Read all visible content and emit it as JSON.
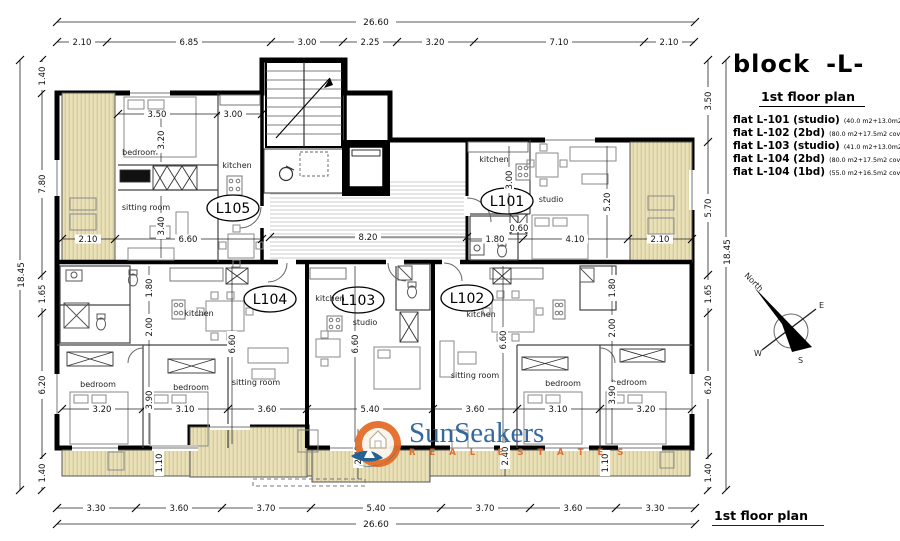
{
  "colors": {
    "wall": "#000000",
    "balcony_fill": "#eae1b9",
    "balcony_hatch": "#cdc291",
    "corridor_hatch": "#c9c9c9",
    "logo_orange": "#e46f2c",
    "logo_blue": "#2b639b",
    "logo_wave_blue": "#1e5d92"
  },
  "title_block": {
    "block_label": "block",
    "block_name": "-L-",
    "plan_title": "1st floor plan",
    "flats": [
      {
        "name": "flat L-101 (studio)",
        "area": "(40.0 m2+13.0m2 cov.ver.)"
      },
      {
        "name": "flat L-102 (2bd)",
        "area": "(80.0 m2+17.5m2 cov.ver.)"
      },
      {
        "name": "flat L-103 (studio)",
        "area": "(41.0 m2+13.0m2 cov.ver.)"
      },
      {
        "name": "flat L-104 (2bd)",
        "area": "(80.0 m2+17.5m2 cov.ver.)"
      },
      {
        "name": "flat L-104 (1bd)",
        "area": "(55.0 m2+16.5m2 cov.ver.)"
      }
    ]
  },
  "footer_title": "1st floor plan",
  "watermark": {
    "brand": "SunSeakers",
    "tagline": "R E A L  E S T A T E S"
  },
  "compass": {
    "north": "North",
    "east": "E",
    "west": "W",
    "south": "S"
  },
  "units": {
    "l101": "L101",
    "l102": "L102",
    "l103": "L103",
    "l104": "L104",
    "l105": "L105"
  },
  "rooms": {
    "bedroom": "bedroom",
    "sitting_room": "sitting room",
    "kitchen": "kitchen",
    "studio": "studio"
  },
  "dims": {
    "top_total": "26.60",
    "top_segments": [
      "2.10",
      "6.85",
      "3.00",
      "2.25",
      "3.20",
      "7.10",
      "2.10"
    ],
    "bottom_total": "26.60",
    "bottom_segments": [
      "3.30",
      "3.60",
      "3.70",
      "5.40",
      "3.70",
      "3.60",
      "3.30"
    ],
    "left_total": "18.45",
    "left_segments": [
      "1.40",
      "7.80",
      "1.65",
      "6.20",
      "1.40"
    ],
    "right_total": "18.45",
    "right_segments": [
      "3.50",
      "5.70",
      "1.65",
      "6.20",
      "1.40"
    ],
    "inner": {
      "l105_bed_w": "3.50",
      "l105_kitchen_w": "3.00",
      "l105_bed_d": "3.20",
      "l105_sitting_d": "3.40",
      "balcony_left_w": "2.10",
      "l105_w": "6.60",
      "corridor_l": "8.20",
      "l101_kitchen_d": "3.00",
      "l101_studio_d": "5.20",
      "l101_hall_w": "0.60",
      "l101_bath_w": "1.80",
      "l101_studio_w": "4.10",
      "balcony_right_w": "2.10",
      "l104_d": "6.60",
      "l103_d": "6.60",
      "l102_d": "6.60",
      "l104_bed1_w": "3.20",
      "l104_bed2_w": "3.10",
      "l104_sitting_w": "3.60",
      "l103_studio_w": "5.40",
      "l102_sitting_w": "3.60",
      "l102_bed1_w": "3.10",
      "l102_bed2_w": "3.20",
      "left_wc_d": "1.80",
      "left_hall_d": "2.00",
      "left_bed_d": "3.90",
      "right_wc_d": "1.80",
      "right_hall_d": "2.00",
      "right_bed_d": "3.90",
      "balcony_left_d": "1.10",
      "balcony_right_d": "1.10",
      "balcony_mid_left_d": "2.40",
      "balcony_mid_right_d": "2.40"
    }
  }
}
